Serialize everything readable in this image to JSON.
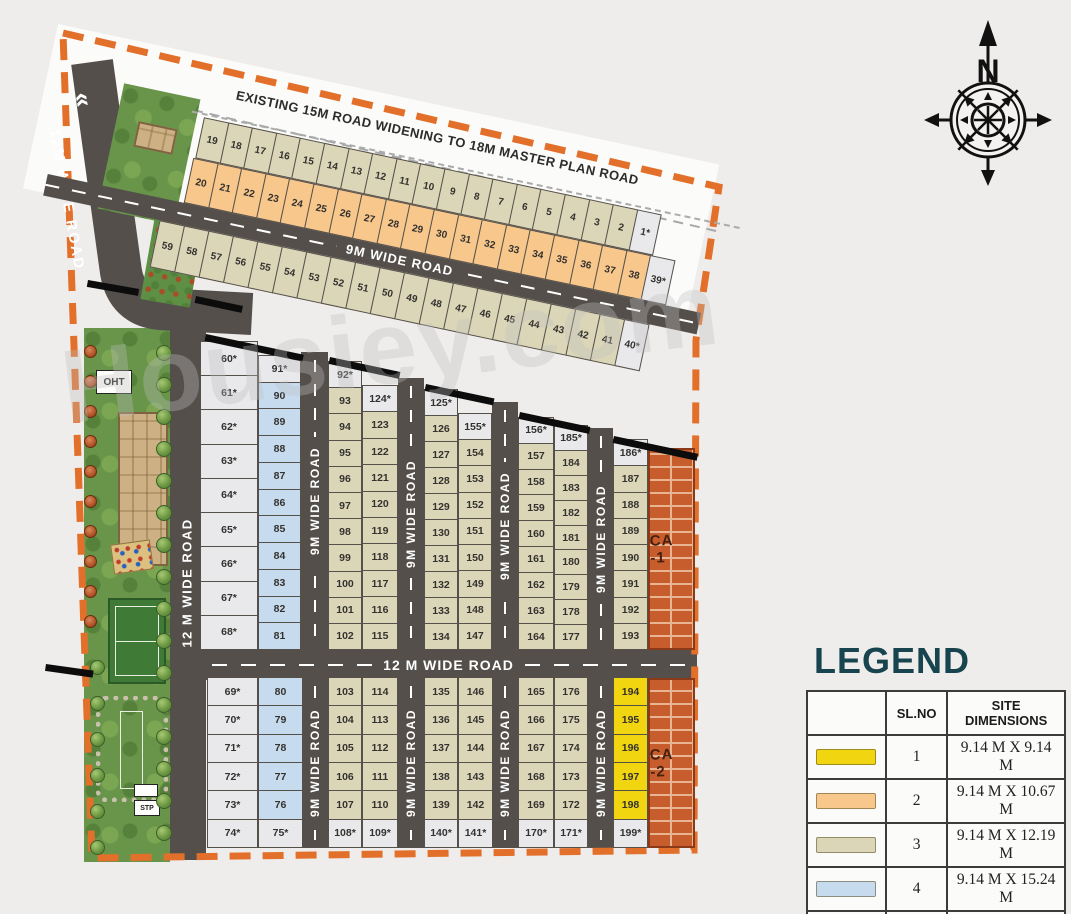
{
  "watermark": "Housiey.com",
  "compass": {
    "label": "N"
  },
  "top_strip": {
    "widening_text": "EXISTING 15M  ROAD WIDENING TO 18M MASTER PLAN ROAD",
    "road_label": "9M WIDE ROAD",
    "row1": [
      {
        "n": "19",
        "t": 3
      },
      {
        "n": "18",
        "t": 3
      },
      {
        "n": "17",
        "t": 3
      },
      {
        "n": "16",
        "t": 3
      },
      {
        "n": "15",
        "t": 3
      },
      {
        "n": "14",
        "t": 3
      },
      {
        "n": "13",
        "t": 3
      },
      {
        "n": "12",
        "t": 3
      },
      {
        "n": "11",
        "t": 3
      },
      {
        "n": "10",
        "t": 3
      },
      {
        "n": "9",
        "t": 3
      },
      {
        "n": "8",
        "t": 3
      },
      {
        "n": "7",
        "t": 3
      },
      {
        "n": "6",
        "t": 3
      },
      {
        "n": "5",
        "t": 3
      },
      {
        "n": "4",
        "t": 3
      },
      {
        "n": "3",
        "t": 3
      },
      {
        "n": "2",
        "t": 3
      },
      {
        "n": "1*",
        "t": 5
      }
    ],
    "row2": [
      {
        "n": "20",
        "t": 2
      },
      {
        "n": "21",
        "t": 2
      },
      {
        "n": "22",
        "t": 2
      },
      {
        "n": "23",
        "t": 2
      },
      {
        "n": "24",
        "t": 2
      },
      {
        "n": "25",
        "t": 2
      },
      {
        "n": "26",
        "t": 2
      },
      {
        "n": "27",
        "t": 2
      },
      {
        "n": "28",
        "t": 2
      },
      {
        "n": "29",
        "t": 2
      },
      {
        "n": "30",
        "t": 2
      },
      {
        "n": "31",
        "t": 2
      },
      {
        "n": "32",
        "t": 2
      },
      {
        "n": "33",
        "t": 2
      },
      {
        "n": "34",
        "t": 2
      },
      {
        "n": "35",
        "t": 2
      },
      {
        "n": "36",
        "t": 2
      },
      {
        "n": "37",
        "t": 2
      },
      {
        "n": "38",
        "t": 2
      },
      {
        "n": "39*",
        "t": 5
      }
    ],
    "row3": [
      {
        "n": "59",
        "t": 3
      },
      {
        "n": "58",
        "t": 3
      },
      {
        "n": "57",
        "t": 3
      },
      {
        "n": "56",
        "t": 3
      },
      {
        "n": "55",
        "t": 3
      },
      {
        "n": "54",
        "t": 3
      },
      {
        "n": "53",
        "t": 3
      },
      {
        "n": "52",
        "t": 3
      },
      {
        "n": "51",
        "t": 3
      },
      {
        "n": "50",
        "t": 3
      },
      {
        "n": "49",
        "t": 3
      },
      {
        "n": "48",
        "t": 3
      },
      {
        "n": "47",
        "t": 3
      },
      {
        "n": "46",
        "t": 3
      },
      {
        "n": "45",
        "t": 3
      },
      {
        "n": "44",
        "t": 3
      },
      {
        "n": "43",
        "t": 3
      },
      {
        "n": "42",
        "t": 3
      },
      {
        "n": "41",
        "t": 3
      },
      {
        "n": "40*",
        "t": 5
      }
    ]
  },
  "roads": {
    "diagonal_label": "12M WIDE ROAD",
    "chevron": "«",
    "left_vertical_label": "12 M WIDE ROAD",
    "middle_label": "12 M WIDE ROAD",
    "v9_label": "9M WIDE ROAD"
  },
  "park": {
    "oht": "OHT",
    "stp": "STP"
  },
  "upper_blocks": [
    {
      "cols": [
        {
          "cells": [
            {
              "n": "60*",
              "t": 5
            },
            {
              "n": "61*",
              "t": 5
            },
            {
              "n": "62*",
              "t": 5
            },
            {
              "n": "63*",
              "t": 5
            },
            {
              "n": "64*",
              "t": 5
            },
            {
              "n": "65*",
              "t": 5
            },
            {
              "n": "66*",
              "t": 5
            },
            {
              "n": "67*",
              "t": 5
            },
            {
              "n": "68*",
              "t": 5
            }
          ]
        },
        {
          "cells": [
            {
              "n": "91*",
              "t": 5
            },
            {
              "n": "90",
              "t": 4
            },
            {
              "n": "89",
              "t": 4
            },
            {
              "n": "88",
              "t": 4
            },
            {
              "n": "87",
              "t": 4
            },
            {
              "n": "86",
              "t": 4
            },
            {
              "n": "85",
              "t": 4
            },
            {
              "n": "84",
              "t": 4
            },
            {
              "n": "83",
              "t": 4
            },
            {
              "n": "82",
              "t": 4
            },
            {
              "n": "81",
              "t": 4
            }
          ]
        }
      ]
    },
    {
      "cols": [
        {
          "cells": [
            {
              "n": "92*",
              "t": 5
            },
            {
              "n": "93",
              "t": 3
            },
            {
              "n": "94",
              "t": 3
            },
            {
              "n": "95",
              "t": 3
            },
            {
              "n": "96",
              "t": 3
            },
            {
              "n": "97",
              "t": 3
            },
            {
              "n": "98",
              "t": 3
            },
            {
              "n": "99",
              "t": 3
            },
            {
              "n": "100",
              "t": 3
            },
            {
              "n": "101",
              "t": 3
            },
            {
              "n": "102",
              "t": 3
            }
          ]
        },
        {
          "cells": [
            {
              "n": "124*",
              "t": 5
            },
            {
              "n": "123",
              "t": 3
            },
            {
              "n": "122",
              "t": 3
            },
            {
              "n": "121",
              "t": 3
            },
            {
              "n": "120",
              "t": 3
            },
            {
              "n": "119",
              "t": 3
            },
            {
              "n": "118",
              "t": 3
            },
            {
              "n": "117",
              "t": 3
            },
            {
              "n": "116",
              "t": 3
            },
            {
              "n": "115",
              "t": 3
            }
          ]
        }
      ]
    },
    {
      "cols": [
        {
          "cells": [
            {
              "n": "125*",
              "t": 5
            },
            {
              "n": "126",
              "t": 3
            },
            {
              "n": "127",
              "t": 3
            },
            {
              "n": "128",
              "t": 3
            },
            {
              "n": "129",
              "t": 3
            },
            {
              "n": "130",
              "t": 3
            },
            {
              "n": "131",
              "t": 3
            },
            {
              "n": "132",
              "t": 3
            },
            {
              "n": "133",
              "t": 3
            },
            {
              "n": "134",
              "t": 3
            }
          ]
        },
        {
          "cells": [
            {
              "n": "155*",
              "t": 5
            },
            {
              "n": "154",
              "t": 3
            },
            {
              "n": "153",
              "t": 3
            },
            {
              "n": "152",
              "t": 3
            },
            {
              "n": "151",
              "t": 3
            },
            {
              "n": "150",
              "t": 3
            },
            {
              "n": "149",
              "t": 3
            },
            {
              "n": "148",
              "t": 3
            },
            {
              "n": "147",
              "t": 3
            }
          ]
        }
      ]
    },
    {
      "cols": [
        {
          "cells": [
            {
              "n": "156*",
              "t": 5
            },
            {
              "n": "157",
              "t": 3
            },
            {
              "n": "158",
              "t": 3
            },
            {
              "n": "159",
              "t": 3
            },
            {
              "n": "160",
              "t": 3
            },
            {
              "n": "161",
              "t": 3
            },
            {
              "n": "162",
              "t": 3
            },
            {
              "n": "163",
              "t": 3
            },
            {
              "n": "164",
              "t": 3
            }
          ]
        },
        {
          "cells": [
            {
              "n": "185*",
              "t": 5
            },
            {
              "n": "184",
              "t": 3
            },
            {
              "n": "183",
              "t": 3
            },
            {
              "n": "182",
              "t": 3
            },
            {
              "n": "181",
              "t": 3
            },
            {
              "n": "180",
              "t": 3
            },
            {
              "n": "179",
              "t": 3
            },
            {
              "n": "178",
              "t": 3
            },
            {
              "n": "177",
              "t": 3
            }
          ]
        }
      ]
    },
    {
      "cols": [
        {
          "cells": [
            {
              "n": "186*",
              "t": 5
            },
            {
              "n": "187",
              "t": 3
            },
            {
              "n": "188",
              "t": 3
            },
            {
              "n": "189",
              "t": 3
            },
            {
              "n": "190",
              "t": 3
            },
            {
              "n": "191",
              "t": 3
            },
            {
              "n": "192",
              "t": 3
            },
            {
              "n": "193",
              "t": 3
            }
          ]
        },
        {
          "brick": true,
          "label": "CA -1"
        }
      ]
    }
  ],
  "lower_blocks": [
    {
      "cols": [
        {
          "cells": [
            {
              "n": "69*",
              "t": 5
            },
            {
              "n": "70*",
              "t": 5
            },
            {
              "n": "71*",
              "t": 5
            },
            {
              "n": "72*",
              "t": 5
            },
            {
              "n": "73*",
              "t": 5
            },
            {
              "n": "74*",
              "t": 5
            }
          ]
        },
        {
          "cells": [
            {
              "n": "80",
              "t": 4
            },
            {
              "n": "79",
              "t": 4
            },
            {
              "n": "78",
              "t": 4
            },
            {
              "n": "77",
              "t": 4
            },
            {
              "n": "76",
              "t": 4
            },
            {
              "n": "75*",
              "t": 5
            }
          ]
        }
      ]
    },
    {
      "cols": [
        {
          "cells": [
            {
              "n": "103",
              "t": 3
            },
            {
              "n": "104",
              "t": 3
            },
            {
              "n": "105",
              "t": 3
            },
            {
              "n": "106",
              "t": 3
            },
            {
              "n": "107",
              "t": 3
            },
            {
              "n": "108*",
              "t": 5
            }
          ]
        },
        {
          "cells": [
            {
              "n": "114",
              "t": 3
            },
            {
              "n": "113",
              "t": 3
            },
            {
              "n": "112",
              "t": 3
            },
            {
              "n": "111",
              "t": 3
            },
            {
              "n": "110",
              "t": 3
            },
            {
              "n": "109*",
              "t": 5
            }
          ]
        }
      ]
    },
    {
      "cols": [
        {
          "cells": [
            {
              "n": "135",
              "t": 3
            },
            {
              "n": "136",
              "t": 3
            },
            {
              "n": "137",
              "t": 3
            },
            {
              "n": "138",
              "t": 3
            },
            {
              "n": "139",
              "t": 3
            },
            {
              "n": "140*",
              "t": 5
            }
          ]
        },
        {
          "cells": [
            {
              "n": "146",
              "t": 3
            },
            {
              "n": "145",
              "t": 3
            },
            {
              "n": "144",
              "t": 3
            },
            {
              "n": "143",
              "t": 3
            },
            {
              "n": "142",
              "t": 3
            },
            {
              "n": "141*",
              "t": 5
            }
          ]
        }
      ]
    },
    {
      "cols": [
        {
          "cells": [
            {
              "n": "165",
              "t": 3
            },
            {
              "n": "166",
              "t": 3
            },
            {
              "n": "167",
              "t": 3
            },
            {
              "n": "168",
              "t": 3
            },
            {
              "n": "169",
              "t": 3
            },
            {
              "n": "170*",
              "t": 5
            }
          ]
        },
        {
          "cells": [
            {
              "n": "176",
              "t": 3
            },
            {
              "n": "175",
              "t": 3
            },
            {
              "n": "174",
              "t": 3
            },
            {
              "n": "173",
              "t": 3
            },
            {
              "n": "172",
              "t": 3
            },
            {
              "n": "171*",
              "t": 5
            }
          ]
        }
      ]
    },
    {
      "cols": [
        {
          "cells": [
            {
              "n": "194",
              "t": 1
            },
            {
              "n": "195",
              "t": 1
            },
            {
              "n": "196",
              "t": 1
            },
            {
              "n": "197",
              "t": 1
            },
            {
              "n": "198",
              "t": 1
            },
            {
              "n": "199*",
              "t": 5
            }
          ]
        },
        {
          "brick": true,
          "label": "CA -2"
        }
      ]
    }
  ],
  "legend": {
    "title": "LEGEND",
    "headers": [
      "",
      "SL.NO",
      "SITE DIMENSIONS"
    ],
    "rows": [
      {
        "slno": "1",
        "dims": "9.14 M X 9.14 M",
        "color": "#f2d511"
      },
      {
        "slno": "2",
        "dims": "9.14 M X 10.67 M",
        "color": "#f7c78c"
      },
      {
        "slno": "3",
        "dims": "9.14 M X 12.19 M",
        "color": "#dbd6b8"
      },
      {
        "slno": "4",
        "dims": "9.14 M X 15.24 M",
        "color": "#c7dbee"
      },
      {
        "slno": "5",
        "dims": "ODDS SITES*",
        "color": "#e9e9ec"
      }
    ]
  },
  "plot_colors": {
    "1": "#f2d511",
    "2": "#f7c78c",
    "3": "#dbd6b8",
    "4": "#c7dbee",
    "5": "#e9e9ec"
  }
}
